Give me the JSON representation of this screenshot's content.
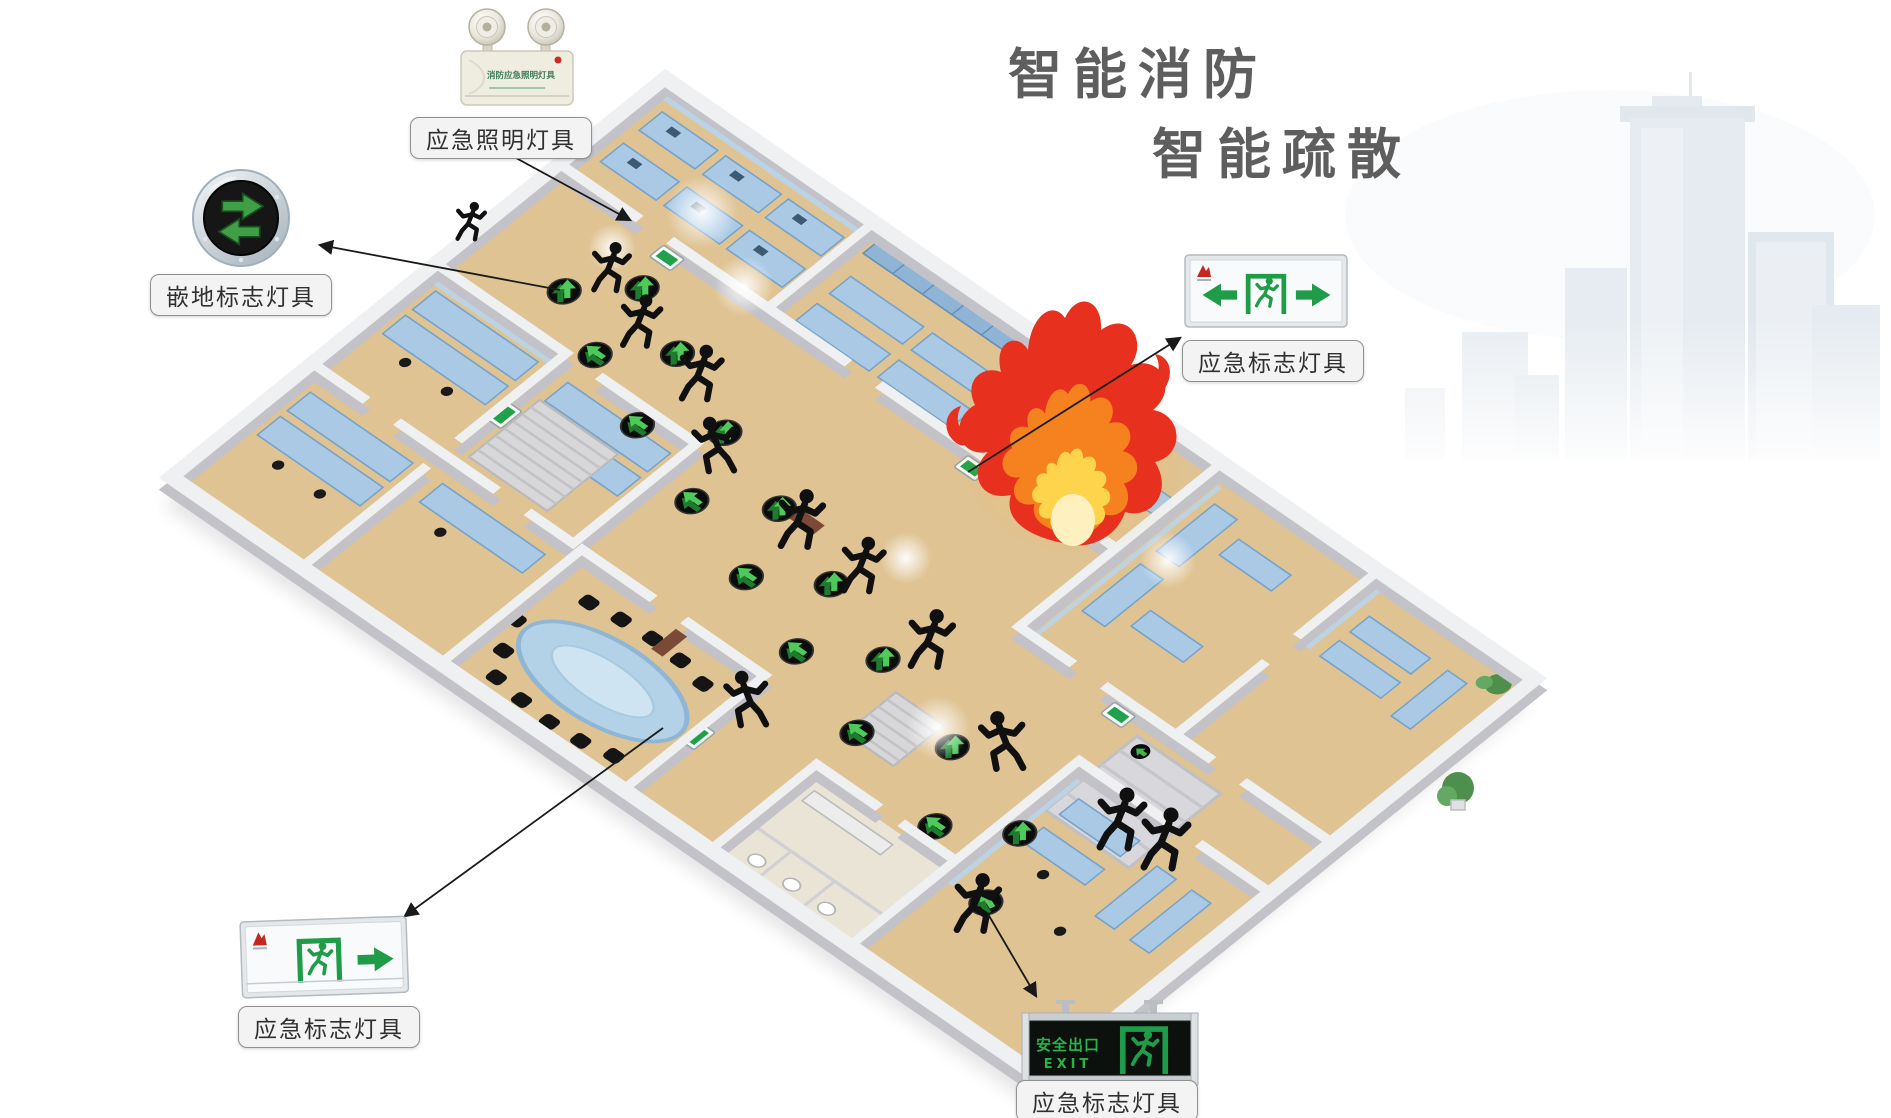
{
  "title": {
    "line1": "智能消防",
    "line2": "智能疏散"
  },
  "callouts": {
    "emergency_lighting": {
      "label": "应急照明灯具",
      "device_text": "消防应急照明灯具"
    },
    "floor_marker": {
      "label": "嵌地标志灯具"
    },
    "exit_sign_right": {
      "label": "应急标志灯具"
    },
    "exit_sign_bottom_left": {
      "label": "应急标志灯具"
    },
    "exit_sign_bottom_center": {
      "label": "应急标志灯具",
      "sign_text_cn": "安全出口",
      "sign_text_en": "EXIT"
    }
  },
  "scene": {
    "type": "isometric office floor plan, smart fire-evacuation illustration",
    "has_fire": true,
    "evacuation_floor_marker_count": 17,
    "running_people_count": 13,
    "wall_exit_sign_count": 5,
    "elements": [
      "city-skyline-watermark",
      "office-floorplan",
      "fire",
      "evacuation-floor-markers",
      "running-people",
      "wall-exit-signs",
      "conference-room-oval-table",
      "cubicles",
      "stairs",
      "restrooms",
      "exterior-exit-ramp"
    ]
  },
  "colors": {
    "title_gray": "#5e5e5e",
    "floor_tan": "#dfc393",
    "wall_gray": "#c2c2c8",
    "wall_top": "#eef0f2",
    "furniture_blue": "#a9c7e2",
    "glass_blue": "#b9d6ec",
    "evac_green": "#3fb54a",
    "sign_green": "#1f9c48",
    "fire_red": "#e8301f",
    "fire_orange": "#f6821f",
    "fire_yellow": "#ffd44d",
    "label_bg": "#f3f3f3",
    "label_border": "#909090",
    "skyline_blue": "#c3d0dd"
  }
}
